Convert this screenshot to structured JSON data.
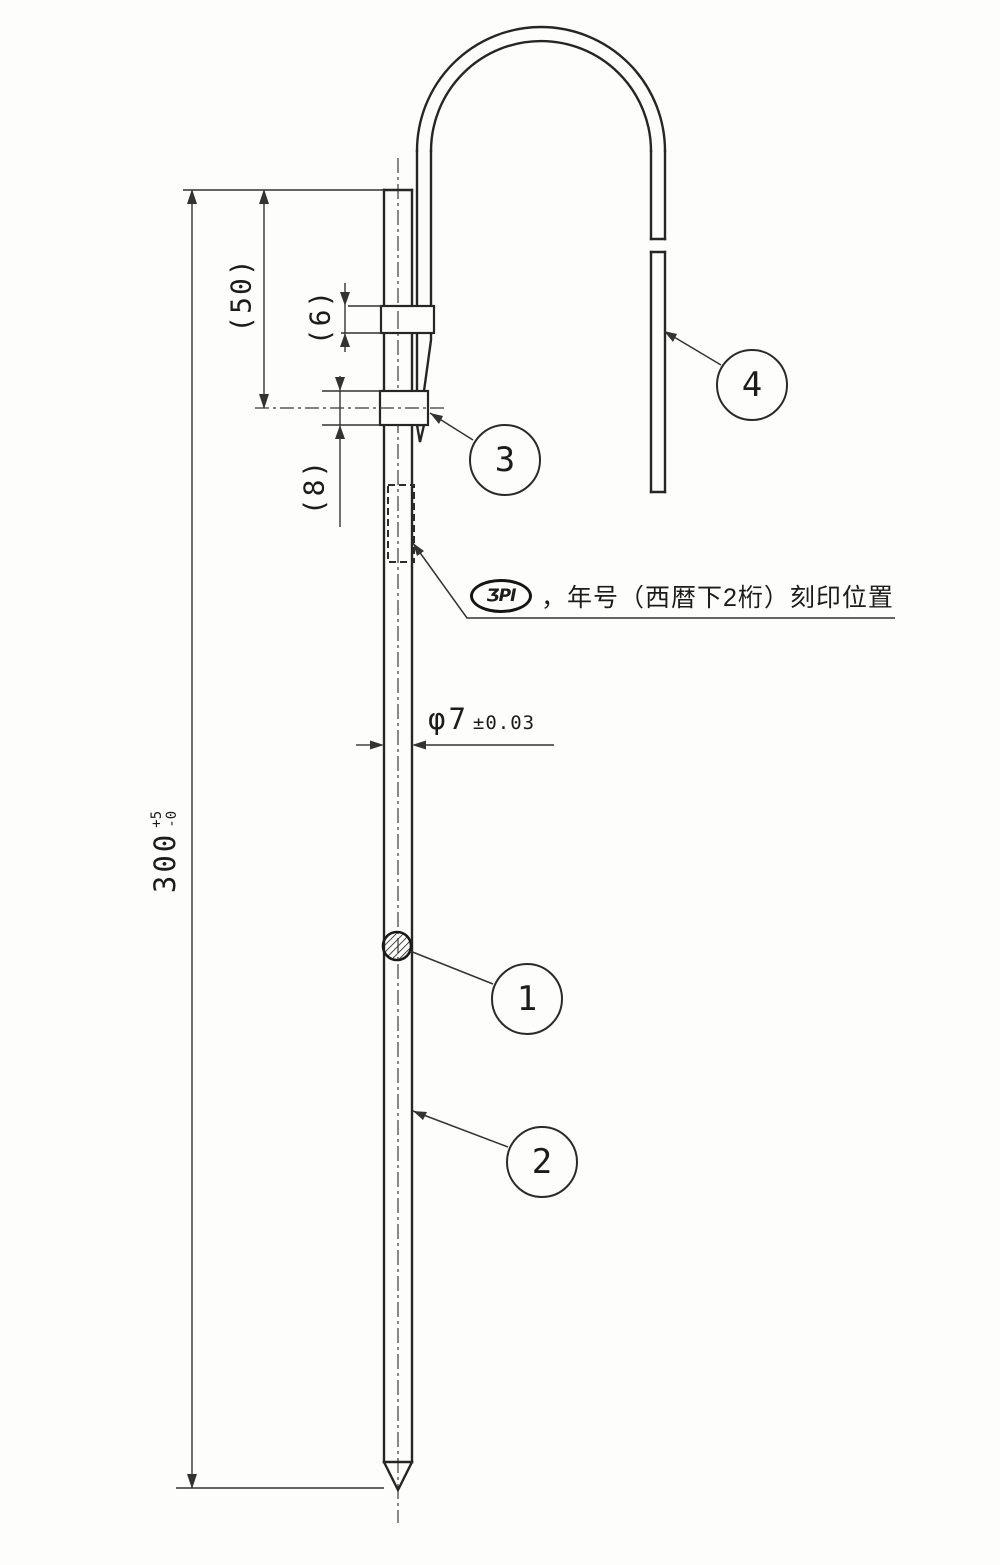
{
  "drawing": {
    "type": "mechanical part drawing (rod with hook)",
    "colors": {
      "line": "#262626",
      "background": "#fdfdfc"
    },
    "dimensions": {
      "overall_length": {
        "value": "300",
        "tol_upper": "+5",
        "tol_lower": "-0"
      },
      "upper_section": "(50)",
      "upper_collar_height": "(6)",
      "lower_collar_height": "(8)",
      "rod_diameter": {
        "value": "φ7",
        "tolerance": "±0.03"
      }
    },
    "balloons": {
      "b1": "1",
      "b2": "2",
      "b3": "3",
      "b4": "4"
    },
    "note": {
      "logo_text": "ƷPI",
      "text": "，年号（西暦下2桁）刻印位置"
    }
  }
}
